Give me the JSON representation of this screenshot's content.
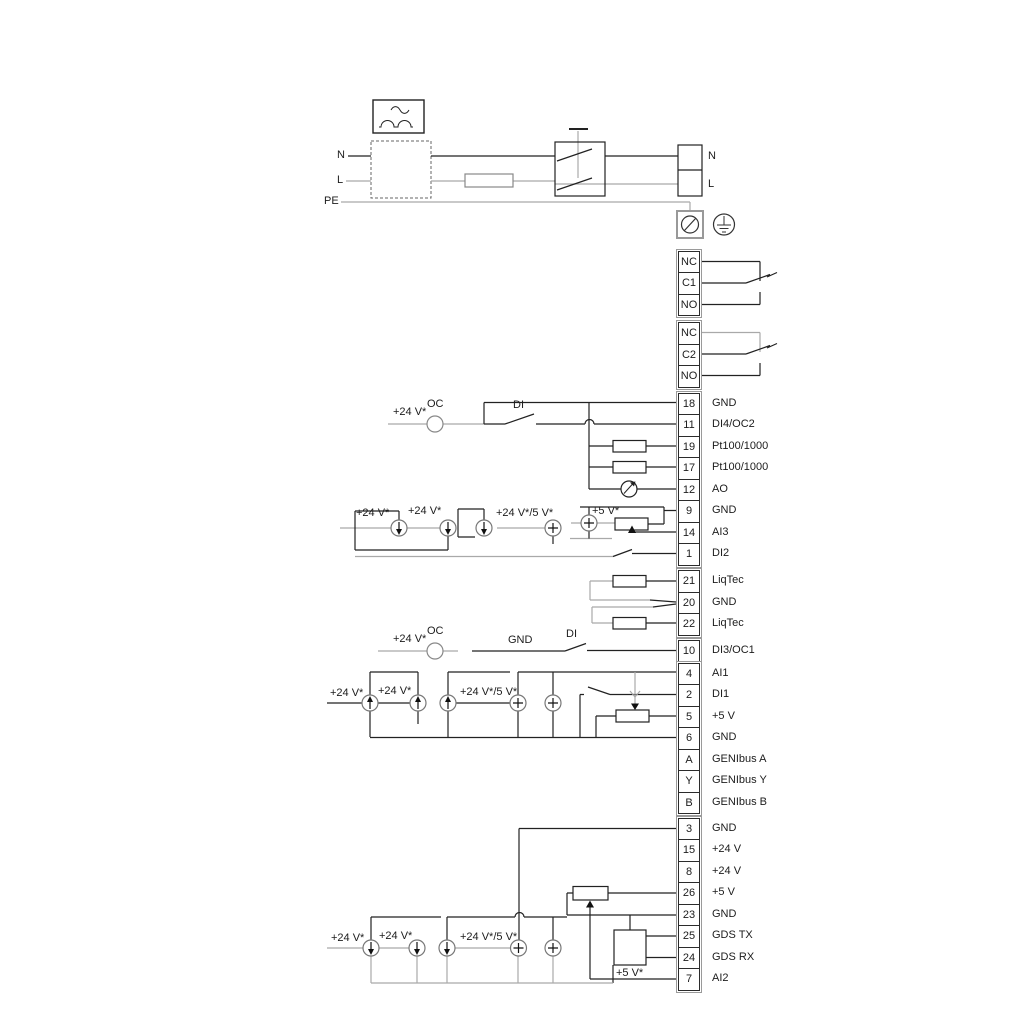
{
  "labels": {
    "power": [
      "N",
      "L",
      "PE",
      "N",
      "L"
    ],
    "sec18": [
      "+24 V*",
      "OC",
      "DI"
    ],
    "sec9": [
      "+24 V*",
      "+24 V*",
      "+24 V*/5 V*",
      "+5 V*"
    ],
    "sec10": [
      "+24 V*",
      "OC",
      "GND",
      "DI"
    ],
    "sec4": [
      "+24 V*",
      "+24 V*",
      "+24 V*/5 V*"
    ],
    "sec3": [
      "+24 V*",
      "+24 V*",
      "+24 V*/5 V*",
      "+5 V*"
    ]
  },
  "terminal_blocks": [
    {
      "name": "relay-1",
      "rows": [
        {
          "num": "NC",
          "label": ""
        },
        {
          "num": "C1",
          "label": ""
        },
        {
          "num": "NO",
          "label": ""
        }
      ]
    },
    {
      "name": "relay-2",
      "rows": [
        {
          "num": "NC",
          "label": ""
        },
        {
          "num": "C2",
          "label": ""
        },
        {
          "num": "NO",
          "label": ""
        }
      ]
    },
    {
      "name": "io-upper",
      "rows": [
        {
          "num": "18",
          "label": "GND"
        },
        {
          "num": "11",
          "label": "DI4/OC2"
        },
        {
          "num": "19",
          "label": "Pt100/1000"
        },
        {
          "num": "17",
          "label": "Pt100/1000"
        },
        {
          "num": "12",
          "label": "AO"
        },
        {
          "num": "9",
          "label": "GND"
        },
        {
          "num": "14",
          "label": "AI3"
        },
        {
          "num": "1",
          "label": "DI2"
        }
      ]
    },
    {
      "name": "liqtec",
      "rows": [
        {
          "num": "21",
          "label": "LiqTec"
        },
        {
          "num": "20",
          "label": "GND"
        },
        {
          "num": "22",
          "label": "LiqTec"
        }
      ]
    },
    {
      "name": "di3",
      "rows": [
        {
          "num": "10",
          "label": "DI3/OC1"
        }
      ]
    },
    {
      "name": "io-mid",
      "rows": [
        {
          "num": "4",
          "label": "AI1"
        },
        {
          "num": "2",
          "label": "DI1"
        },
        {
          "num": "5",
          "label": "+5 V"
        },
        {
          "num": "6",
          "label": "GND"
        },
        {
          "num": "A",
          "label": "GENIbus A"
        },
        {
          "num": "Y",
          "label": "GENIbus Y"
        },
        {
          "num": "B",
          "label": "GENIbus B"
        }
      ]
    },
    {
      "name": "io-bottom",
      "rows": [
        {
          "num": "3",
          "label": "GND"
        },
        {
          "num": "15",
          "label": "+24 V"
        },
        {
          "num": "8",
          "label": "+24 V"
        },
        {
          "num": "26",
          "label": "+5 V"
        },
        {
          "num": "23",
          "label": "GND"
        },
        {
          "num": "25",
          "label": "GDS TX"
        },
        {
          "num": "24",
          "label": "GDS RX"
        },
        {
          "num": "7",
          "label": "AI2"
        }
      ]
    }
  ]
}
